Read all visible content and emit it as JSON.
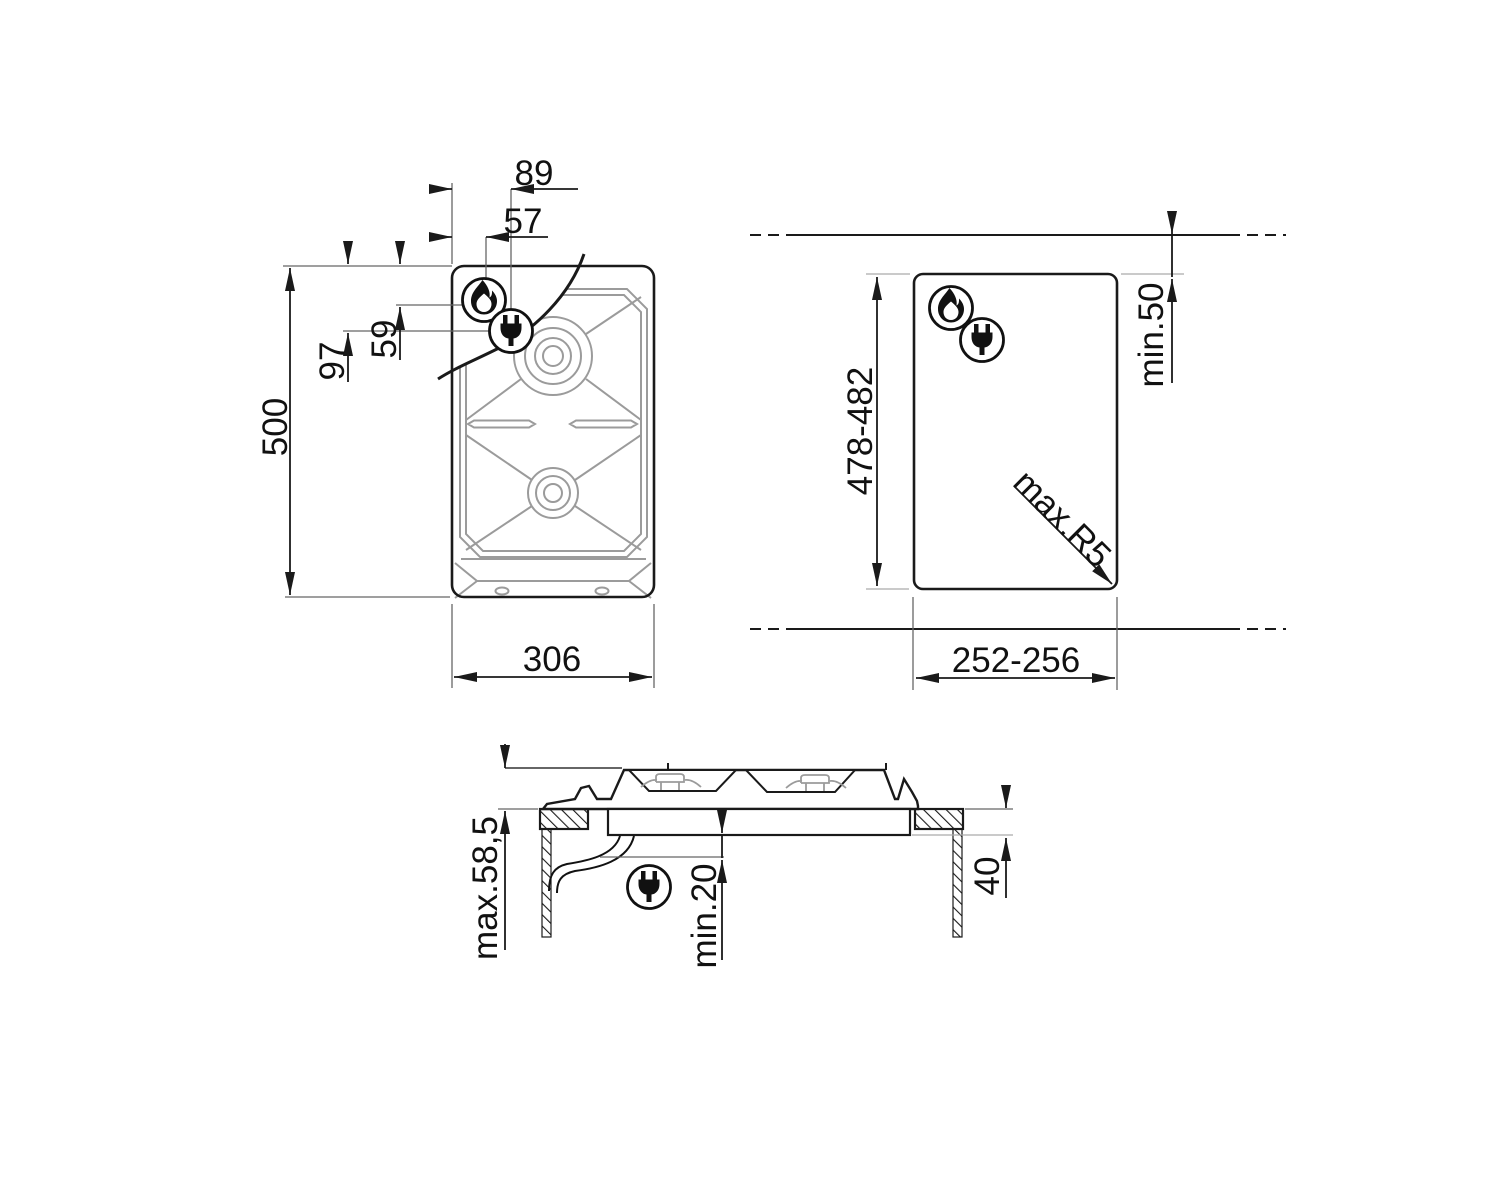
{
  "colors": {
    "line": "#1a1a1a",
    "detail": "#9b9b9b",
    "background": "#ffffff"
  },
  "views": {
    "plan": {
      "title": "hob-top-view",
      "width": "306",
      "height": "500",
      "plug_offset_x": "89",
      "flame_offset_x": "57",
      "plug_offset_y": "97",
      "flame_offset_y": "59"
    },
    "cutout": {
      "title": "worktop-cutout-view",
      "width": "252-256",
      "height": "478-482",
      "rear_clearance": "min.50",
      "corner_radius": "max.R5"
    },
    "section": {
      "title": "side-section-view",
      "height_above_top": "max.58,5",
      "clearance_below": "min.20",
      "recess_depth": "40"
    }
  },
  "icons": {
    "gas": "flame-icon",
    "electric": "plug-icon"
  }
}
